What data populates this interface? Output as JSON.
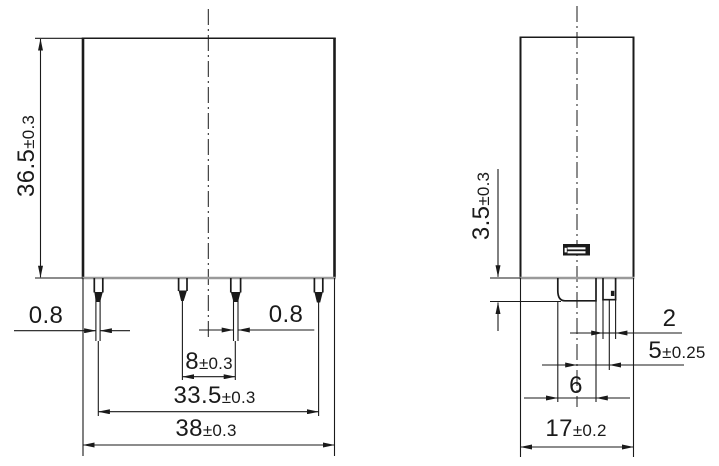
{
  "palette": {
    "background": "#ffffff",
    "ink": "#1a1a1a",
    "shaded_edge": "#9a9a9a"
  },
  "dims": {
    "front_height": {
      "value": "36.5",
      "tol": "±0.3"
    },
    "front_pin_tip_left": {
      "value": "0.8",
      "tol": ""
    },
    "front_pin_tip_right": {
      "value": "0.8",
      "tol": ""
    },
    "front_pin_pitch": {
      "value": "8",
      "tol": "±0.3"
    },
    "front_pin_span": {
      "value": "33.5",
      "tol": "±0.3"
    },
    "front_width": {
      "value": "38",
      "tol": "±0.3"
    },
    "side_pin_length": {
      "value": "3.5",
      "tol": "±0.3"
    },
    "side_pin_width": {
      "value": "2",
      "tol": ""
    },
    "side_pin_offset": {
      "value": "5",
      "tol": "±0.25"
    },
    "side_tab_width": {
      "value": "6",
      "tol": ""
    },
    "side_depth": {
      "value": "17",
      "tol": "±0.2"
    }
  }
}
